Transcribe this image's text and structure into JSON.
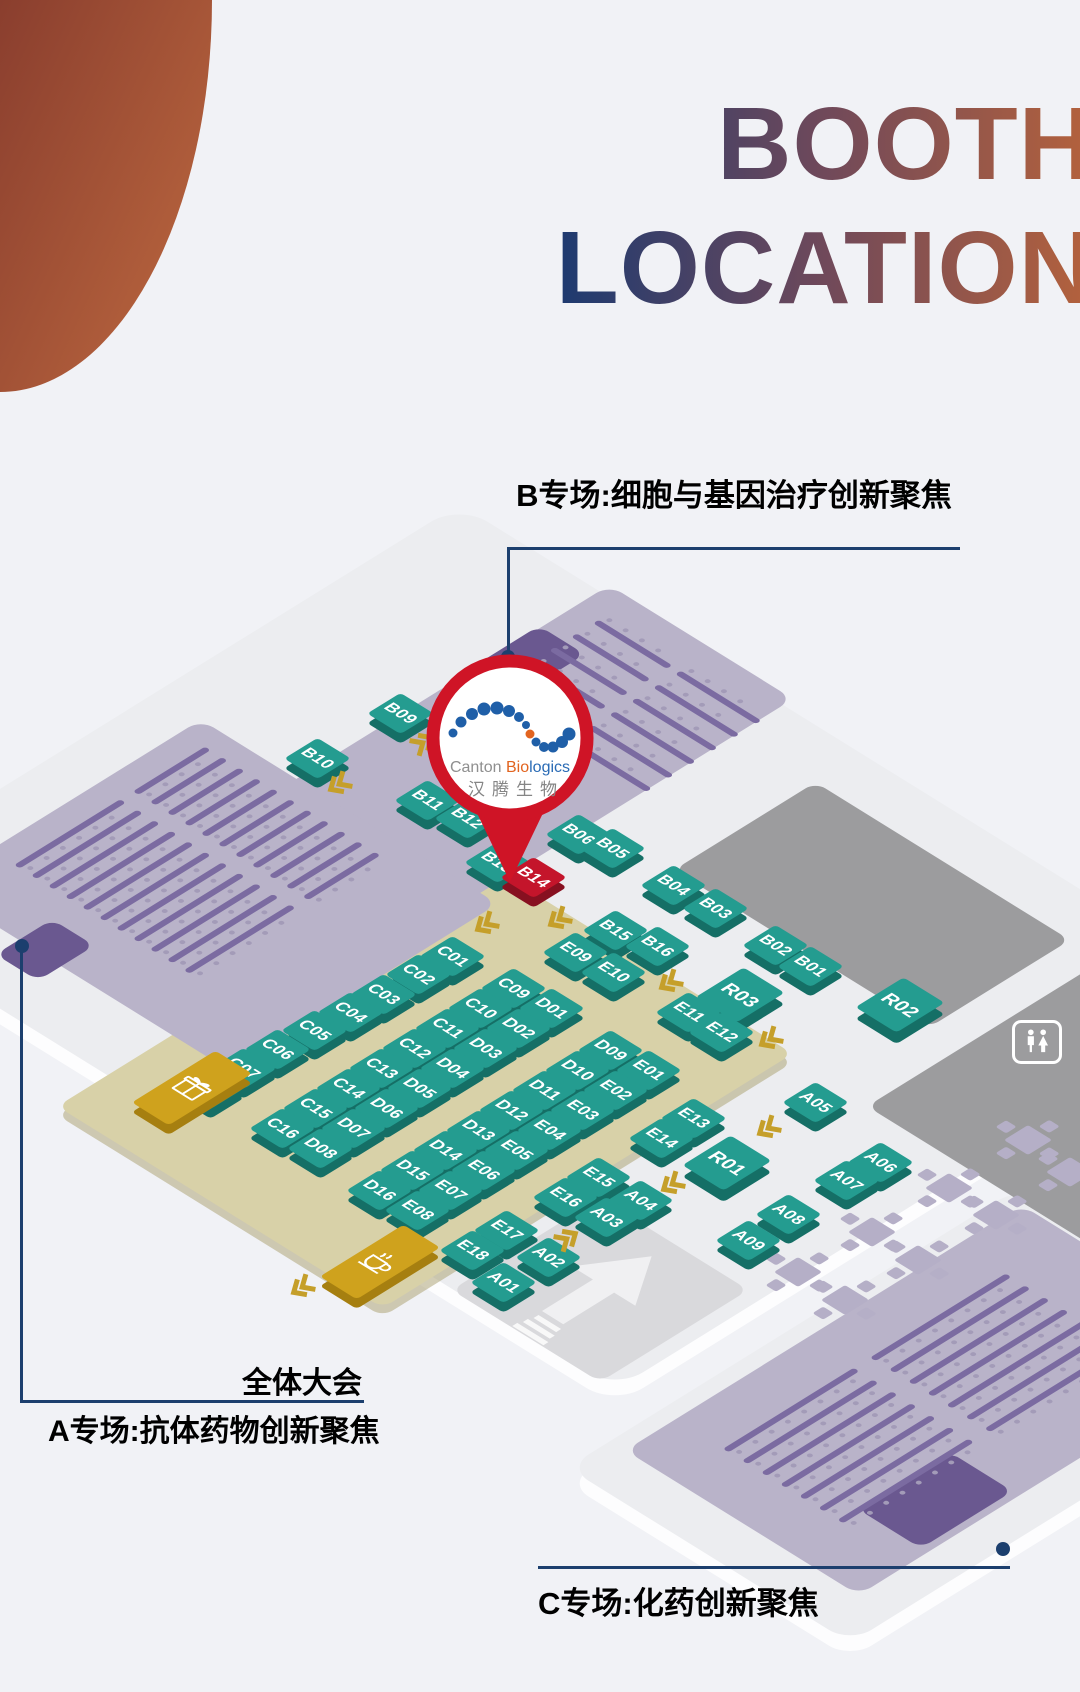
{
  "title": {
    "line1": "BOOTH",
    "line2": "LOCATION"
  },
  "corner_decoration": {
    "color_dark": "#8a3e2e",
    "color_light": "#bf6a40"
  },
  "session_labels": {
    "hall_b": "B专场:细胞与基因治疗创新聚焦",
    "plenary": "全体大会",
    "hall_a": "A专场:抗体药物创新聚焦",
    "hall_c": "C专场:化药创新聚焦"
  },
  "pin": {
    "en_gray": "Canton ",
    "en_orange": "Bio",
    "en_blue": "logics",
    "company_cn": "汉腾生物",
    "highlight_booth": "B14",
    "ring_color": "#cf1426"
  },
  "colors": {
    "navy": "#1c3f6e",
    "booth_top": "#249c90",
    "booth_side": "#156f66",
    "booth_red_top": "#c4152b",
    "booth_red_side": "#871020",
    "gold_top": "#cfa21d",
    "gold_side": "#a67f10",
    "hall_bg": "#b9b3c9",
    "seat_bar": "#7b6ba1",
    "seat_dot": "#a39bb8",
    "stage": "#6a5890",
    "floor": "#ecedf0",
    "khaki": "#d8d1a8",
    "gray_zone": "#9c9c9e",
    "entrance": "#d9d9dc",
    "gold_arrow": "#c59f2a",
    "table": "#b5afc7"
  },
  "map": {
    "floors": [
      {
        "name": "main-floor",
        "x": 537,
        "y": 947,
        "w": 900,
        "h": 1120,
        "r": 40
      },
      {
        "name": "hall-c-floor",
        "x": 935,
        "y": 1415,
        "w": 640,
        "h": 400,
        "r": 30
      }
    ],
    "zones": [
      {
        "name": "gray-zone-upper",
        "x": 872,
        "y": 905,
        "w": 200,
        "h": 360,
        "fill": "gray_zone"
      },
      {
        "name": "gray-zone-lower",
        "x": 1150,
        "y": 1080,
        "w": 460,
        "h": 340,
        "fill": "gray_zone"
      },
      {
        "name": "khaki-booth-zone",
        "x": 425,
        "y": 1080,
        "w": 580,
        "h": 460,
        "fill": "khaki"
      },
      {
        "name": "entrance-plaza",
        "x": 600,
        "y": 1290,
        "w": 210,
        "h": 210,
        "fill": "entrance",
        "arrow": true
      }
    ],
    "halls": [
      {
        "name": "hall-b",
        "x": 535,
        "y": 745,
        "w": 470,
        "h": 260,
        "stage": {
          "x": 516,
          "y": 668,
          "w": 130,
          "h": 65
        },
        "seats": {
          "cx": 632,
          "cy": 700,
          "w": 190,
          "h": 230,
          "orient": "v",
          "pitch": 31,
          "lanes": 6,
          "segs": [
            [
              0,
              104
            ],
            [
              116,
              114
            ]
          ]
        }
      },
      {
        "name": "hall-a",
        "x": 215,
        "y": 895,
        "w": 380,
        "h": 420,
        "stage": {
          "x": 45,
          "y": 950,
          "w": 80,
          "h": 60
        },
        "seats": {
          "cx": 205,
          "cy": 865,
          "w": 270,
          "h": 270,
          "orient": "h",
          "pitch": 24,
          "lanes": 11,
          "segs": [
            [
              0,
              150
            ],
            [
              168,
              102
            ]
          ]
        }
      },
      {
        "name": "hall-c",
        "x": 940,
        "y": 1400,
        "w": 560,
        "h": 330,
        "stage": {
          "x": 935,
          "y": 1500,
          "w": 130,
          "h": 90
        },
        "seats": {
          "cx": 935,
          "cy": 1405,
          "w": 400,
          "h": 200,
          "orient": "h",
          "pitch": 27,
          "lanes": 7,
          "segs": [
            [
              0,
              185
            ],
            [
              208,
              192
            ]
          ]
        }
      }
    ],
    "booths": [
      [
        "B09",
        400,
        713
      ],
      [
        "B10",
        317,
        758
      ],
      [
        "B11",
        427,
        800
      ],
      [
        "B12",
        467,
        818
      ],
      [
        "B13",
        497,
        862
      ],
      [
        "B14",
        533,
        877,
        "r"
      ],
      [
        "B06",
        578,
        834
      ],
      [
        "B05",
        612,
        848
      ],
      [
        "B04",
        673,
        885
      ],
      [
        "B03",
        715,
        908
      ],
      [
        "B02",
        775,
        945
      ],
      [
        "B01",
        810,
        966
      ],
      [
        "B15",
        615,
        930
      ],
      [
        "B16",
        657,
        946
      ],
      [
        "R03",
        740,
        995,
        "l"
      ],
      [
        "R02",
        900,
        1005,
        "l"
      ],
      [
        "R01",
        727,
        1163,
        "l"
      ],
      [
        "C01",
        452,
        956
      ],
      [
        "C02",
        418,
        974
      ],
      [
        "C03",
        383,
        994
      ],
      [
        "C04",
        350,
        1012
      ],
      [
        "C05",
        314,
        1030
      ],
      [
        "C06",
        277,
        1049
      ],
      [
        "C07",
        243,
        1068
      ],
      [
        "C08",
        210,
        1088
      ],
      [
        "C09",
        513,
        988
      ],
      [
        "C10",
        480,
        1008
      ],
      [
        "C11",
        447,
        1028
      ],
      [
        "C12",
        414,
        1048
      ],
      [
        "C13",
        381,
        1068
      ],
      [
        "C14",
        348,
        1088
      ],
      [
        "C15",
        315,
        1108
      ],
      [
        "C16",
        282,
        1128
      ],
      [
        "D01",
        551,
        1008
      ],
      [
        "D02",
        518,
        1028
      ],
      [
        "D03",
        485,
        1048
      ],
      [
        "D04",
        452,
        1068
      ],
      [
        "D05",
        419,
        1088
      ],
      [
        "D06",
        386,
        1108
      ],
      [
        "D07",
        353,
        1128
      ],
      [
        "D08",
        320,
        1148
      ],
      [
        "D09",
        610,
        1050
      ],
      [
        "D10",
        577,
        1070
      ],
      [
        "D11",
        544,
        1090
      ],
      [
        "D12",
        511,
        1110
      ],
      [
        "D13",
        478,
        1130
      ],
      [
        "D14",
        445,
        1150
      ],
      [
        "D15",
        412,
        1170
      ],
      [
        "D16",
        379,
        1190
      ],
      [
        "E01",
        648,
        1070
      ],
      [
        "E02",
        615,
        1090
      ],
      [
        "E03",
        582,
        1110
      ],
      [
        "E04",
        549,
        1130
      ],
      [
        "E05",
        516,
        1150
      ],
      [
        "E06",
        483,
        1170
      ],
      [
        "E07",
        450,
        1190
      ],
      [
        "E08",
        417,
        1210
      ],
      [
        "E09",
        575,
        952
      ],
      [
        "E10",
        613,
        972
      ],
      [
        "E11",
        688,
        1012
      ],
      [
        "E12",
        721,
        1032
      ],
      [
        "E13",
        693,
        1118
      ],
      [
        "E14",
        661,
        1138
      ],
      [
        "E15",
        598,
        1177
      ],
      [
        "E16",
        565,
        1197
      ],
      [
        "E17",
        506,
        1230
      ],
      [
        "E18",
        472,
        1250
      ],
      [
        "A01",
        503,
        1282
      ],
      [
        "A02",
        548,
        1257
      ],
      [
        "A03",
        606,
        1217
      ],
      [
        "A04",
        640,
        1200
      ],
      [
        "A05",
        815,
        1102
      ],
      [
        "A06",
        880,
        1162
      ],
      [
        "A07",
        846,
        1180
      ],
      [
        "A08",
        788,
        1214
      ],
      [
        "A09",
        748,
        1240
      ]
    ],
    "service_booths": [
      {
        "icon": "gift-icon",
        "x": 192,
        "y": 1088
      },
      {
        "icon": "coffee-icon",
        "x": 380,
        "y": 1262
      }
    ],
    "tables": [
      [
        1028,
        1140
      ],
      [
        1070,
        1172
      ],
      [
        949,
        1188
      ],
      [
        996,
        1215
      ],
      [
        872,
        1232
      ],
      [
        918,
        1260
      ],
      [
        798,
        1272
      ],
      [
        845,
        1300
      ]
    ],
    "flow_arrows": [
      [
        425,
        742,
        -32
      ],
      [
        337,
        780,
        148
      ],
      [
        484,
        920,
        148
      ],
      [
        557,
        915,
        148
      ],
      [
        668,
        978,
        148
      ],
      [
        768,
        1035,
        148
      ],
      [
        766,
        1124,
        148
      ],
      [
        670,
        1180,
        148
      ],
      [
        569,
        1238,
        -32
      ],
      [
        300,
        1283,
        148
      ]
    ],
    "restroom": {
      "x": 1012,
      "y": 1020
    },
    "connectors": {
      "b": {
        "h": [
          508,
          547,
          452
        ],
        "v": [
          507,
          547,
          110
        ],
        "dot": [
          501,
          650
        ]
      },
      "a": {
        "v": [
          20,
          946,
          456
        ],
        "h": [
          20,
          1400,
          344
        ],
        "dot": [
          15,
          939
        ]
      },
      "c": {
        "h": [
          538,
          1566,
          472
        ],
        "dot": [
          996,
          1542
        ]
      }
    }
  }
}
